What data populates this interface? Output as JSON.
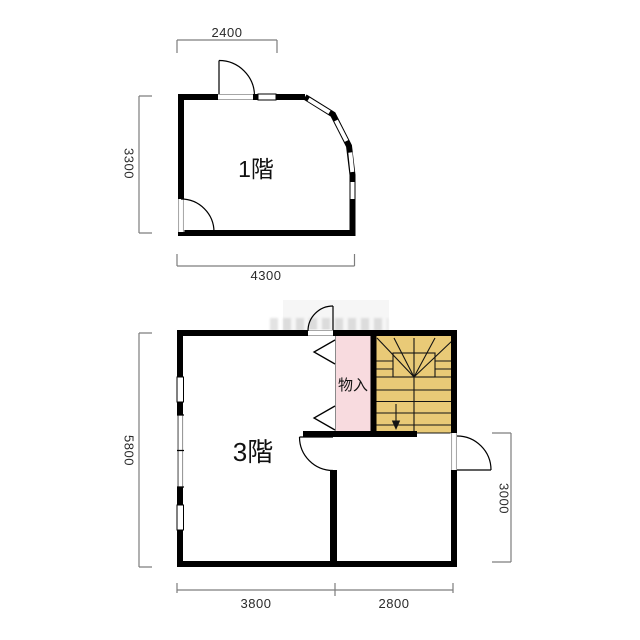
{
  "document": {
    "type": "floor-plan",
    "floors_shown": [
      "1階",
      "3階"
    ]
  },
  "floor1": {
    "name": "1階",
    "dimensions": {
      "top": "2400",
      "left": "3300",
      "bottom": "4300"
    },
    "features": [
      "entry-door-top",
      "door-bottom-left",
      "curved-bay-windows-right",
      "window-top"
    ]
  },
  "floor3": {
    "name": "3階",
    "closet_label": "物入",
    "stair_direction": "down",
    "dimensions": {
      "left": "5800",
      "bottom_left": "3800",
      "bottom_right": "2800",
      "right": "3000"
    },
    "features": [
      "storage-closet",
      "switchback-staircase",
      "door-top",
      "door-right",
      "interior-door",
      "windows-left-wall"
    ]
  },
  "colors": {
    "wall": "#000000",
    "stair_fill": "#e9ca77",
    "closet_fill": "#f8dbdf",
    "dim_line": "#7d7d7d",
    "label_text": "#1a1a1a"
  }
}
